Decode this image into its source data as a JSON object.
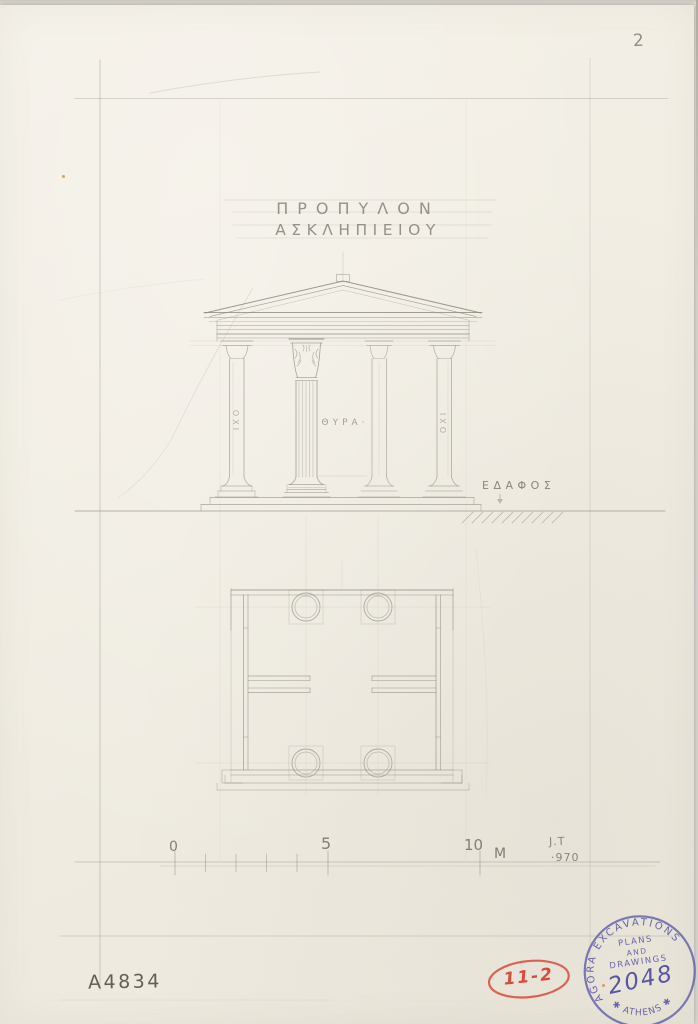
{
  "sheet": {
    "page_number": "2",
    "catalog_number": "A4834",
    "red_tag": "11-2",
    "title_line1": "ΠΡΟΠΥΛΟΝ",
    "title_line2": "ΑΣΚΛΗΠΙΕΙΟΥ"
  },
  "elevation": {
    "door_label": "ΘΥΡΑ·",
    "ground_label": "ΕΔΑΦΟΣ",
    "left_pier_label": "ΟΧΙ",
    "right_pier_label": "ΟΧΙ"
  },
  "scale_bar": {
    "tick_labels": [
      "0",
      "5",
      "10"
    ],
    "unit": "M",
    "initials": "J.T",
    "year": "·970"
  },
  "stamp": {
    "arc_top": "AGORA EXCAVATIONS",
    "line1": "PLANS",
    "line2": "AND",
    "line3": "DRAWINGS",
    "number": "2048",
    "arc_bottom": "✱ ATHENS ✱"
  },
  "colors": {
    "paper": "#f1ede3",
    "pencil": "#8b8880",
    "pencil_dark": "#6f6d66",
    "stamp_red": "#da4a3c",
    "stamp_blue": "#5b59a5"
  }
}
